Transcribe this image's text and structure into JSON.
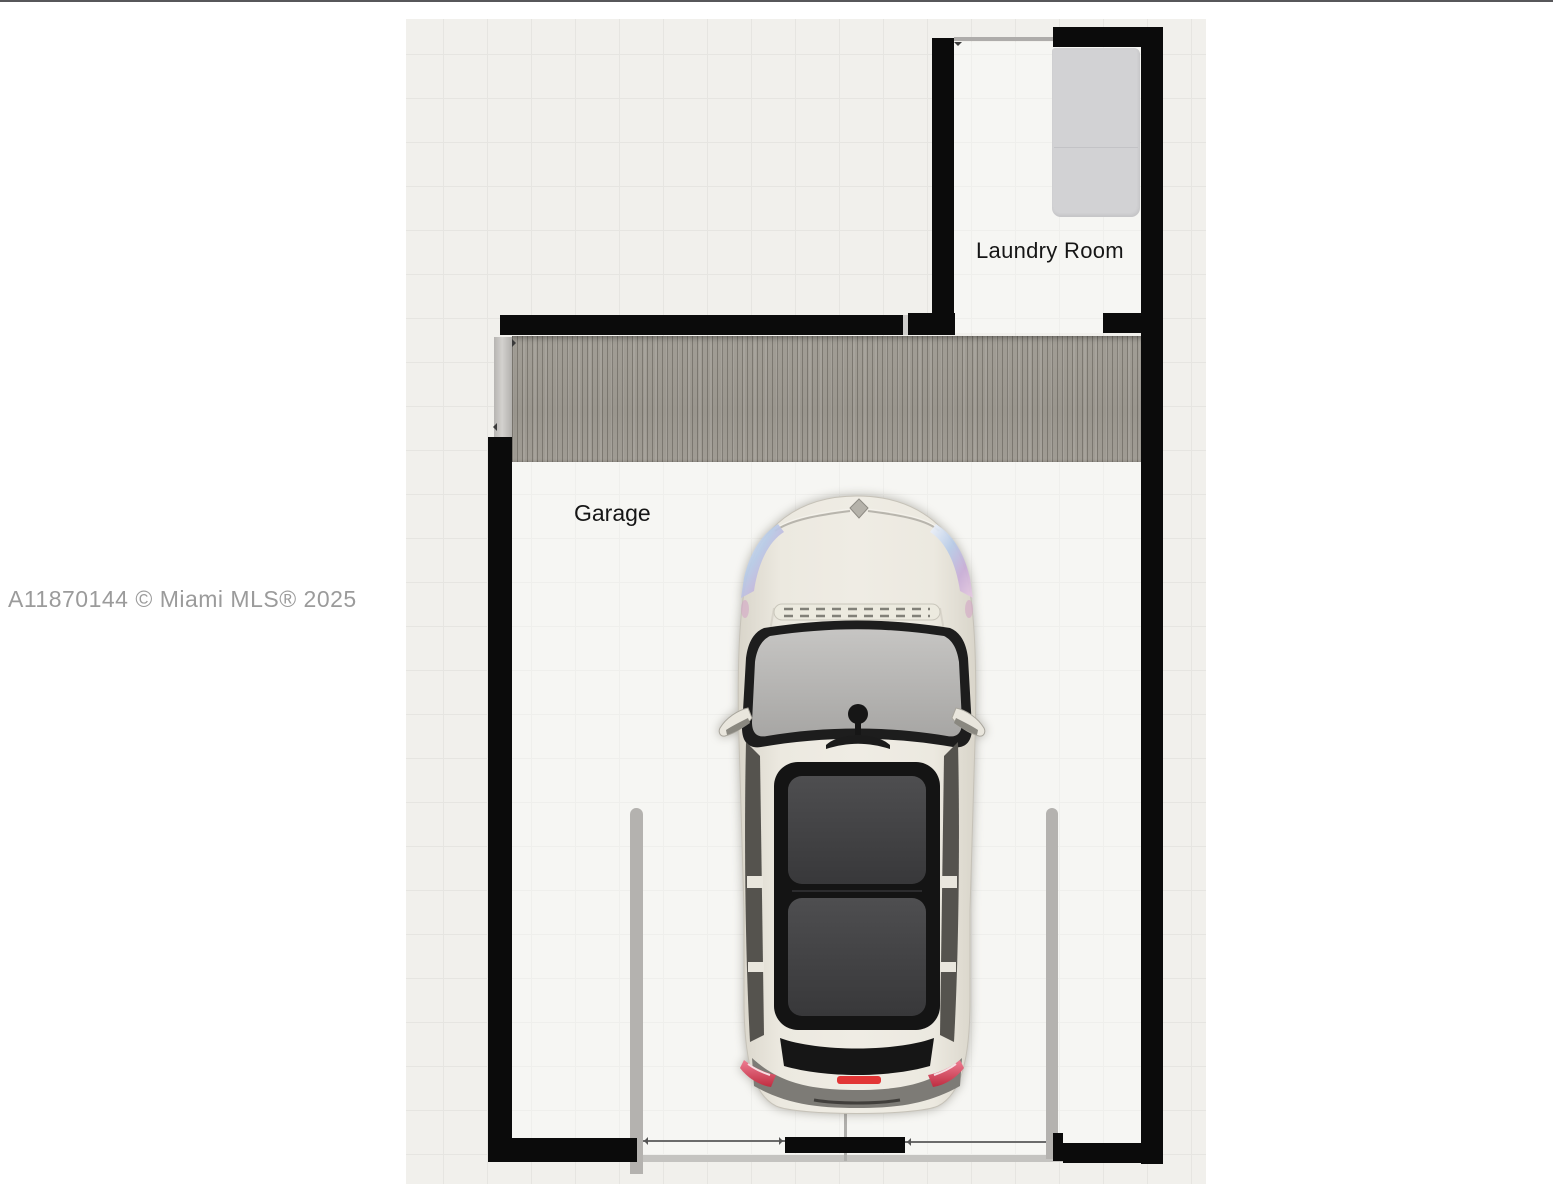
{
  "page": {
    "background_color": "#ffffff",
    "top_edge_line_color": "#57575a"
  },
  "watermark": {
    "text": "A11870144 © Miami MLS® 2025",
    "color": "#9b9b9b"
  },
  "floorplan": {
    "labels": {
      "garage": "Garage",
      "laundry_room": "Laundry Room"
    },
    "colors": {
      "floor": "#f1f0ec",
      "grid_line": "#e6e5e1",
      "wall": "#0b0b0b",
      "garage_door_panel": "#9d9991",
      "washer_dryer": "#d2d2d4",
      "car_body": "#eae7de",
      "car_glass": "#b3b2b0",
      "car_roof_glass": "#424244",
      "taillight_red": "#d93a4a"
    },
    "objects": {
      "car": "white hatchback seen from above parked in garage",
      "washer_dryer": "gray appliance block in laundry room",
      "garage_door": "wood-textured garage door band along top wall"
    }
  }
}
